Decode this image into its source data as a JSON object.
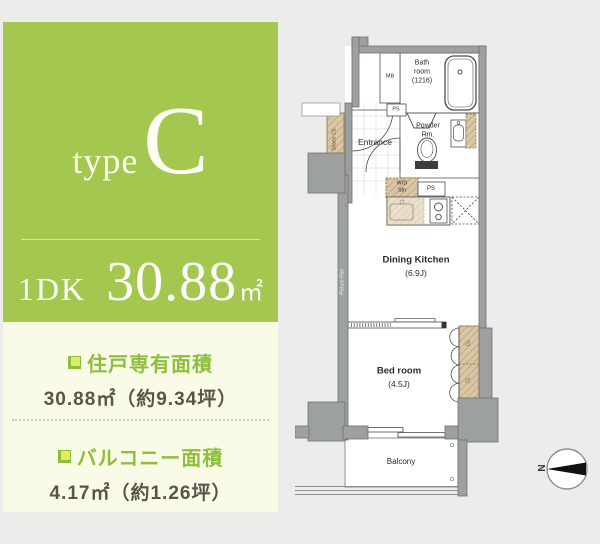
{
  "colors": {
    "page_bg": "#ecedeb",
    "panel_green": "#a4c84f",
    "panel_cream": "#fafbe7",
    "accent_green": "#8cbf3c",
    "text_dark": "#57554a",
    "wall_gray": "#9da0a1",
    "closet_tan": "#d9c6a4"
  },
  "panel": {
    "type_word": "type",
    "type_letter": "C",
    "layout_label": "1DK",
    "area_number": "30.88",
    "area_unit": "㎡",
    "exclusive_area": {
      "title": "住戸専有面積",
      "value": "30.88㎡（約9.34坪）"
    },
    "balcony_area": {
      "title": "バルコニー面積",
      "value": "4.17㎡（約1.26坪）"
    }
  },
  "floorplan": {
    "bath_room": {
      "line1": "Bath",
      "line2": "room",
      "line3": "(1216)"
    },
    "mb_label": "MB",
    "ps_label_1": "PS",
    "ps_label_2": "PS",
    "entrance_label": "Entrance",
    "shoes_label": "Shoes Cb.",
    "powder_room": {
      "line1": "Powder",
      "line2": "Rm."
    },
    "wd_station": {
      "line1": "W/D",
      "line2": "Stn"
    },
    "dining_kitchen": {
      "name": "Dining Kitchen",
      "size": "(6.9J)"
    },
    "bed_room": {
      "name": "Bed room",
      "size": "(4.5J)"
    },
    "closet_label_1": "CL",
    "closet_label_2": "CL",
    "balcony_label": "Balcony",
    "picture_rail_label": "Picture Rail",
    "compass_letter": "N"
  }
}
